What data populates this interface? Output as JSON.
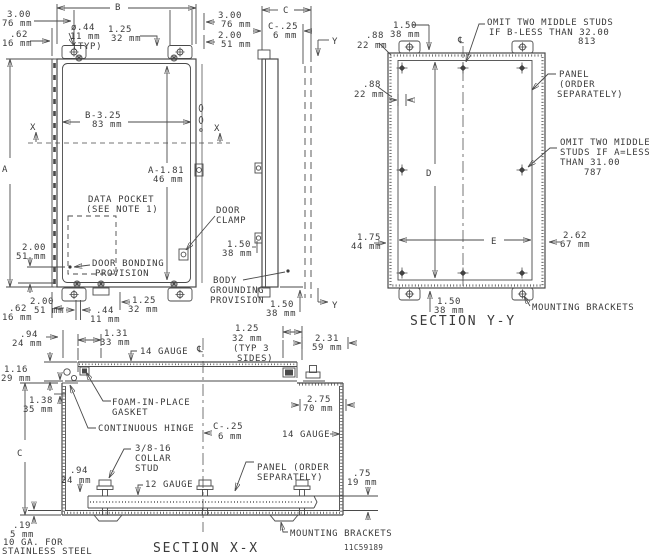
{
  "part_number": "11C59189",
  "colors": {
    "ink": "#4a4a4a",
    "background": "#ffffff"
  },
  "fv": {
    "dim_b": "B",
    "dim_a": "A",
    "x_left": "X",
    "x_right": "X",
    "d300_tl": [
      "3.00",
      "76 mm"
    ],
    "d62_tl": [
      ".62",
      "16 mm"
    ],
    "dia44": [
      "ø.44",
      "11 mm",
      "(TYP)"
    ],
    "d125_t": [
      "1.25",
      "32 mm"
    ],
    "d300_tr": [
      "3.00",
      "76 mm"
    ],
    "d200_tr": [
      "2.00",
      "51 mm"
    ],
    "b325": [
      "B-3.25",
      "83 mm"
    ],
    "a181": [
      "A-1.81",
      "46 mm"
    ],
    "data_pocket": [
      "DATA POCKET",
      "(SEE NOTE 1)"
    ],
    "door_clamp": [
      "DOOR",
      "CLAMP"
    ],
    "d200_l": [
      "2.00",
      "51 mm"
    ],
    "door_bonding": [
      "DOOR BONDING",
      "PROVISION"
    ],
    "d62_b": [
      ".62",
      "16 mm"
    ],
    "d200_b": [
      "2.00",
      "51 mm"
    ],
    "d44_b": [
      ".44",
      "11 mm"
    ],
    "d125_b": [
      "1.25",
      "32 mm"
    ]
  },
  "sv": {
    "dim_c": "C",
    "c25": [
      "C-.25",
      "6 mm"
    ],
    "y_top": "Y",
    "y_bot": "Y",
    "d150_clamp": [
      "1.50",
      "38 mm"
    ],
    "body_grounding": [
      "BODY",
      "GROUNDING",
      "PROVISION"
    ],
    "d150_b": [
      "1.50",
      "38 mm"
    ]
  },
  "yy": {
    "title": "SECTION Y-Y",
    "centerline": "℄",
    "d150_t": [
      "1.50",
      "38 mm"
    ],
    "d88_1": [
      ".88",
      "22 mm"
    ],
    "d88_2": [
      ".88",
      "22 mm"
    ],
    "omit_b": [
      "OMIT TWO MIDDLE STUDS",
      "IF B-LESS THAN 32.00",
      "813"
    ],
    "panel": [
      "PANEL",
      "(ORDER",
      "SEPARATELY)"
    ],
    "omit_a": [
      "OMIT TWO MIDDLE",
      "STUDS IF A=LESS",
      "THAN 31.00",
      "787"
    ],
    "dim_d": "D",
    "dim_e": "E",
    "d175": [
      "1.75",
      "44 mm"
    ],
    "d262": [
      "2.62",
      "67 mm"
    ],
    "d150_b": [
      "1.50",
      "38 mm"
    ],
    "mounting_brackets": "MOUNTING BRACKETS"
  },
  "xx": {
    "title": "SECTION X-X",
    "centerline": "℄",
    "dim_c": "C",
    "d94_t": [
      ".94",
      "24 mm"
    ],
    "d131": [
      "1.31",
      "33 mm"
    ],
    "gauge14_door": "14 GAUGE",
    "d125_typ": [
      "1.25",
      "32 mm",
      "(TYP 3",
      "SIDES)"
    ],
    "d231": [
      "2.31",
      "59 mm"
    ],
    "d116": [
      "1.16",
      "29 mm"
    ],
    "d138": [
      "1.38",
      "35 mm"
    ],
    "foam": [
      "FOAM-IN-PLACE",
      "GASKET"
    ],
    "d275": [
      "2.75",
      "70 mm"
    ],
    "hinge": "CONTINUOUS HINGE",
    "c25": [
      "C-.25",
      "6 mm"
    ],
    "gauge14_wall": "14 GAUGE",
    "collar_stud": [
      "3/8-16",
      "COLLAR",
      "STUD"
    ],
    "d94_b": [
      ".94",
      "24 mm"
    ],
    "gauge12": "12 GAUGE",
    "panel": [
      "PANEL (ORDER",
      "SEPARATELY)"
    ],
    "d75": [
      ".75",
      "19 mm"
    ],
    "d19": [
      ".19",
      "5 mm"
    ],
    "stainless": [
      "10 GA. FOR",
      "STAINLESS STEEL"
    ],
    "mounting_brackets": "MOUNTING BRACKETS"
  }
}
